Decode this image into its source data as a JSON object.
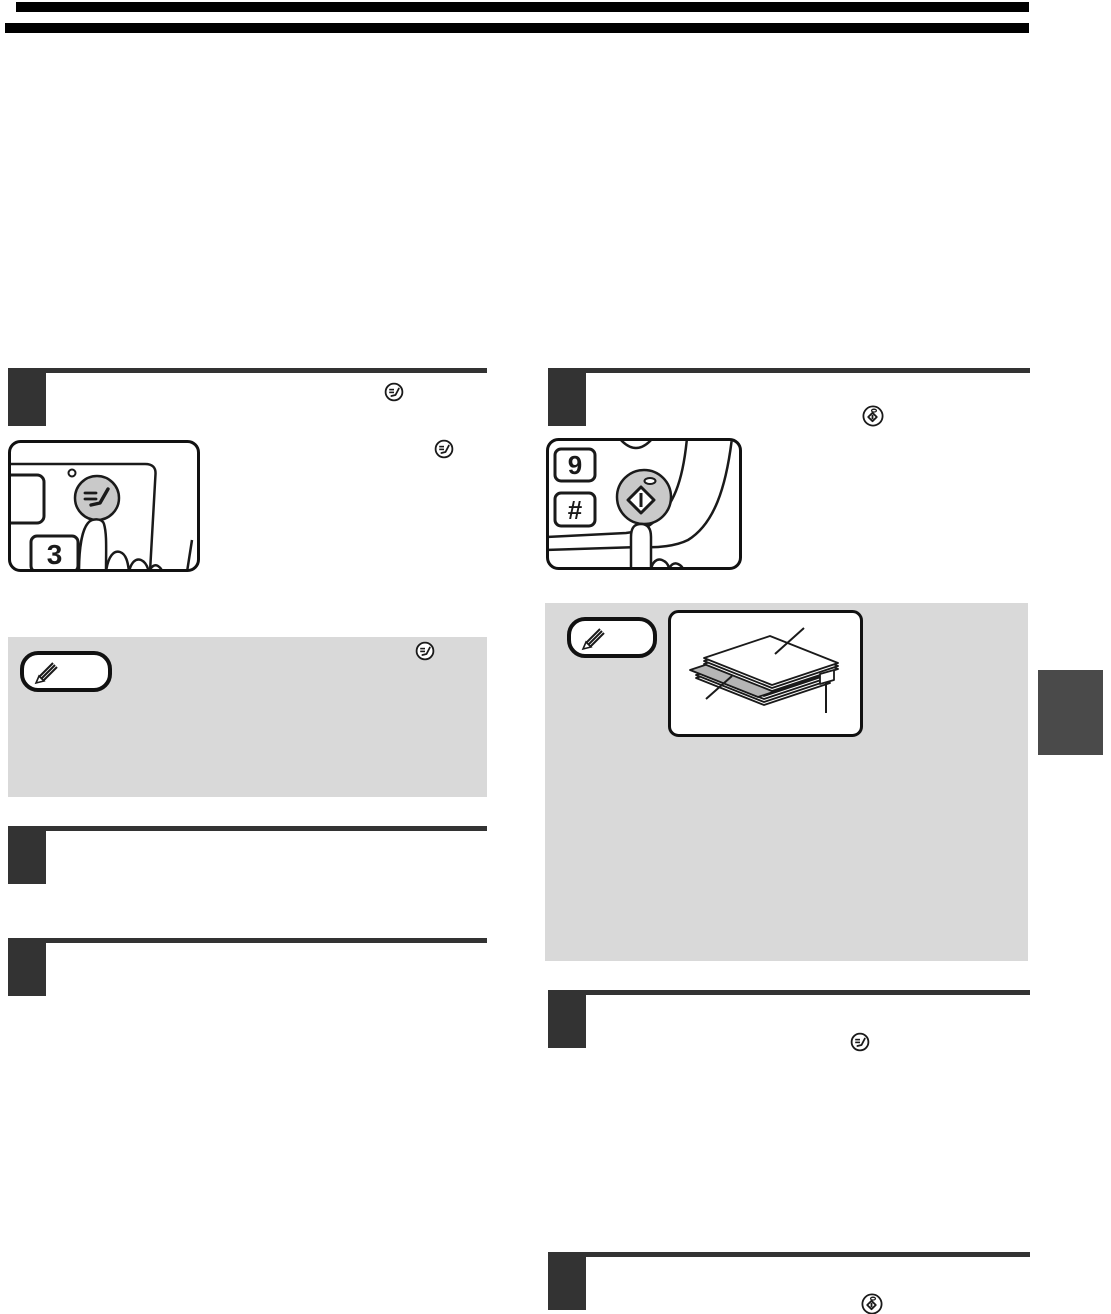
{
  "document": {
    "kind": "scanned instruction manual page",
    "page_background": "#ffffff"
  },
  "colors": {
    "header_bar": "#000000",
    "step_marker": "#333333",
    "step_rule": "#333333",
    "note_box_background": "#d9d9d9",
    "panel_button_gray": "#c9c9c9",
    "insert_sheet_gray": "#b5b5b5",
    "side_tab": "#4a4a4a",
    "line_art": "#1a1a1a"
  },
  "header": {
    "rule_count": 2
  },
  "left_column": {
    "step_count": 3,
    "panel_illustration": {
      "key_label": "3"
    },
    "note_box": {
      "badge": "pencil note badge",
      "body_text": ""
    }
  },
  "right_column": {
    "step_count": 3,
    "panel_illustration": {
      "key_top_label": "9",
      "key_bottom_label": "#"
    },
    "note_box": {
      "badge": "pencil note badge",
      "body_text": ""
    }
  },
  "icons": {
    "account_clear_key": "small circle containing two dashes and a check stroke",
    "start_key": "small circle containing a diamond with a vertical bar and a dot above",
    "note_pencil": "striped pencil inside rounded pill"
  }
}
